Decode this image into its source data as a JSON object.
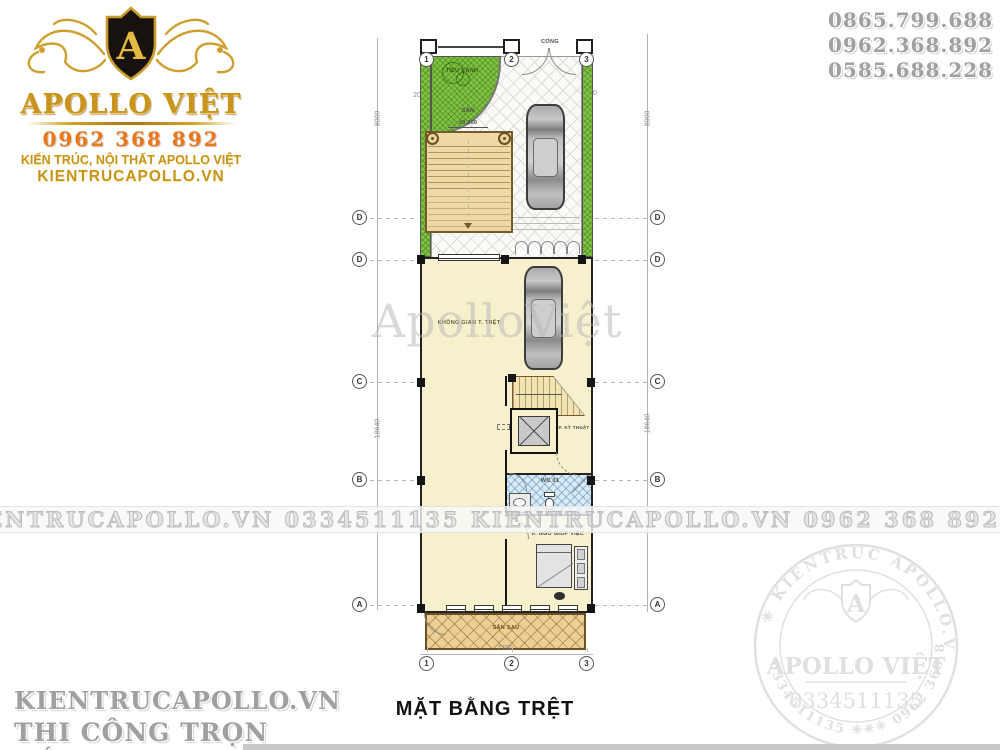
{
  "branding": {
    "logo": {
      "monogram": "A",
      "name": "APOLLO VIỆT",
      "phone": "0962 368 892",
      "tagline": "KIẾN TRÚC, NỘI THẤT APOLLO VIỆT",
      "website": "KIENTRUCAPOLLO.VN",
      "gold_color": "#c9941c",
      "phone_color": "#e8771d"
    },
    "contact_numbers": [
      "0865.799.688",
      "0962.368.892",
      "0585.688.228"
    ],
    "footer_left": {
      "line1": "KIENTRUCAPOLLO.VN",
      "line2": "THI CÔNG TRỌN GÓI!"
    },
    "seal": {
      "ring_text_top": "✳  KIENTRUC APOLLO.VN  ✳",
      "ring_text_bottom": "0334511135  ✳✳✳  0962 368 892",
      "monogram": "A",
      "name": "APOLLO VIỆT",
      "number": "0334511135"
    }
  },
  "watermarks": {
    "center_text": "ApolloViệt",
    "band_text": "KIENTRUCAPOLLO.VN   0334511135   KIENTRUCAPOLLO.VN   0962 368 892   KIENTRUCAPOLLO.VN   0334511135"
  },
  "plan": {
    "title": "MẶT BẰNG TRỆT",
    "grid_columns": [
      "1",
      "2",
      "3"
    ],
    "grid_rows": [
      "D",
      "D",
      "C",
      "B",
      "A"
    ],
    "dims": {
      "front_width": "6000",
      "margin_left": "200",
      "garden_width": "4000",
      "gate_width": "3400",
      "margin_right": "200",
      "front_depth": "8000",
      "house_depth": "18640",
      "total_width": "7700"
    },
    "labels": {
      "gate": "CỔNG",
      "garden": "TIỂU CẢNH",
      "yard": "SÂN",
      "yard_level": "±0.200",
      "main_space": "KHÔNG GIAN T. TRỆT",
      "technical_room": "P. KỸ THUẬT",
      "wc": "WC 01",
      "maid_room": "P. NGỦ GIÚP VIỆC",
      "back_yard": "SÂN SAU"
    },
    "colors": {
      "grass": "#80c243",
      "interior": "#f6f0cd",
      "ramp": "#eed9a4",
      "backyard": "#eccf96",
      "wc_tile": "#d7eaf5"
    }
  }
}
